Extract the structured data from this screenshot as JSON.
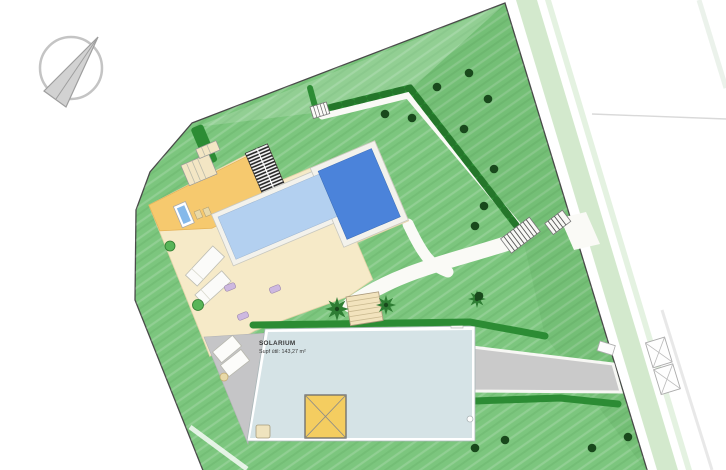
{
  "labels": {
    "solarium_title": "SOLARIUM",
    "solarium_area": "Supf útil: 143,27 m²"
  },
  "colors": {
    "lawn": "#7cc67e",
    "hedge": "#2c8c34",
    "tree": "#19491c",
    "palm": "#2e7d33",
    "pool-light": "#b3d0f0",
    "pool-dark": "#4b83da",
    "deck": "#f3f2ec",
    "terrace-orange": "#f6c96e",
    "terrace-beige": "#f6eac8",
    "entrance-steps": "#f3e6c4",
    "solarium": "#d5e3e6",
    "patio-gray": "#c5c5c7",
    "driveway": "#cacaca",
    "verge": "#cee7c8",
    "skylight": "#f4cd60",
    "boundary": "#4a4a4a",
    "path": "#fafaf6",
    "stairs-beige": "#f2e3bd",
    "mat-purple": "#cdb8e0",
    "bush": "#58b558"
  },
  "landscape": {
    "trees": [
      [
        469,
        73
      ],
      [
        437,
        87
      ],
      [
        488,
        99
      ],
      [
        385,
        114
      ],
      [
        412,
        118
      ],
      [
        464,
        129
      ],
      [
        494,
        169
      ],
      [
        484,
        206
      ],
      [
        475,
        226
      ],
      [
        479,
        296
      ],
      [
        475,
        448
      ],
      [
        505,
        440
      ],
      [
        592,
        448
      ],
      [
        628,
        437
      ]
    ],
    "palms": [
      [
        337,
        309,
        12
      ],
      [
        386,
        305,
        10
      ],
      [
        477,
        299,
        9
      ]
    ]
  }
}
